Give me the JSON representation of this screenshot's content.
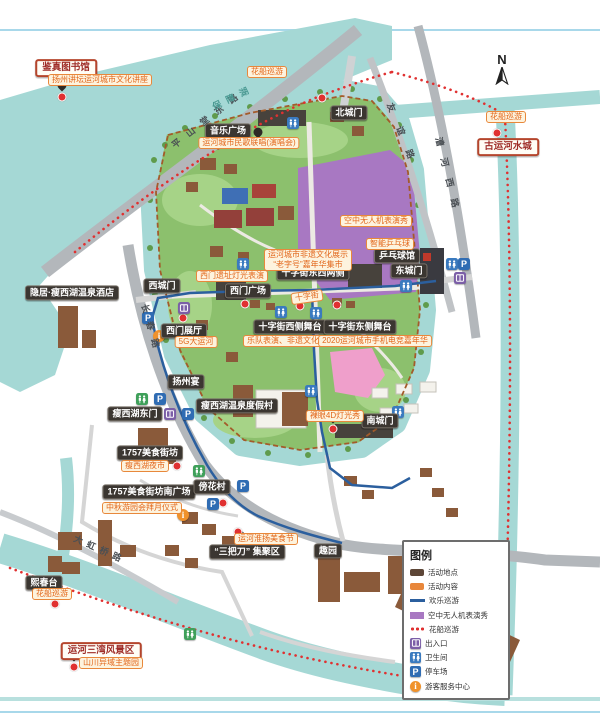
{
  "page": {
    "compass_label": "N"
  },
  "colors": {
    "water": "#a5d8d5",
    "park_green": "#8cc06d",
    "road_gray": "#b3b7bb",
    "route_blue": "#2b5f9e",
    "route_red": "#e03131",
    "boundary_brown": "#a35b2a",
    "drone_purple": "#a878c2",
    "venue_chip": "#3b3631",
    "activity_orange": "#e8873b",
    "landmark_red": "#b5452c"
  },
  "legend": {
    "title": "图例",
    "items": [
      {
        "label": "活动地点",
        "swatch": "venue"
      },
      {
        "label": "活动内容",
        "swatch": "activity"
      },
      {
        "label": "欢乐巡游",
        "swatch": "blueline"
      },
      {
        "label": "空中无人机表演秀",
        "swatch": "purple"
      },
      {
        "label": "花船巡游",
        "swatch": "reddots"
      },
      {
        "label": "出入口",
        "swatch": "entrance"
      },
      {
        "label": "卫生间",
        "swatch": "wc"
      },
      {
        "label": "停车场",
        "swatch": "parking"
      },
      {
        "label": "游客服务中心",
        "swatch": "service"
      }
    ]
  },
  "map": {
    "venues": [
      {
        "text": "北城门",
        "x": 349,
        "y": 113,
        "style": "dark"
      },
      {
        "text": "音乐广场",
        "x": 228,
        "y": 131,
        "style": "dark"
      },
      {
        "text": "西城门",
        "x": 162,
        "y": 286,
        "style": "dark"
      },
      {
        "text": "西门广场",
        "x": 248,
        "y": 291,
        "style": "dark"
      },
      {
        "text": "十字街东西两侧",
        "x": 313,
        "y": 273,
        "style": "dark"
      },
      {
        "text": "乒乓球馆",
        "x": 397,
        "y": 256,
        "style": "dark"
      },
      {
        "text": "东城门",
        "x": 409,
        "y": 271,
        "style": "dark"
      },
      {
        "text": "十字街西侧舞台",
        "x": 290,
        "y": 327,
        "style": "dark"
      },
      {
        "text": "十字街东侧舞台",
        "x": 360,
        "y": 327,
        "style": "dark"
      },
      {
        "text": "西门展厅",
        "x": 184,
        "y": 331,
        "style": "dark"
      },
      {
        "text": "扬州宴",
        "x": 186,
        "y": 382,
        "style": "dark"
      },
      {
        "text": "瘦西湖温泉度假村",
        "x": 237,
        "y": 406,
        "style": "dark"
      },
      {
        "text": "瘦西湖东门",
        "x": 135,
        "y": 414,
        "style": "dark"
      },
      {
        "text": "1757美食街坊",
        "x": 150,
        "y": 453,
        "style": "dark"
      },
      {
        "text": "1757美食街坊南广场",
        "x": 149,
        "y": 492,
        "style": "dark"
      },
      {
        "text": "傍花村",
        "x": 212,
        "y": 487,
        "style": "dark"
      },
      {
        "text": "南城门",
        "x": 380,
        "y": 421,
        "style": "dark"
      },
      {
        "text": "“三把刀” 集聚区",
        "x": 247,
        "y": 552,
        "style": "dark"
      },
      {
        "text": "趣园",
        "x": 328,
        "y": 551,
        "style": "dark"
      },
      {
        "text": "熙春台",
        "x": 44,
        "y": 583,
        "style": "dark"
      },
      {
        "text": "隐居·瘦西湖温泉酒店",
        "x": 72,
        "y": 293,
        "style": "dark"
      },
      {
        "text": "鉴真图书馆",
        "x": 66,
        "y": 68,
        "style": "redbox"
      },
      {
        "text": "古运河水城",
        "x": 508,
        "y": 147,
        "style": "redbox"
      },
      {
        "text": "运河三湾风景区",
        "x": 101,
        "y": 651,
        "style": "redbox"
      }
    ],
    "activities": [
      {
        "text": "花船巡游",
        "x": 267,
        "y": 72
      },
      {
        "text": "花船巡游",
        "x": 506,
        "y": 117
      },
      {
        "text": "扬州讲坛运河城市文化讲座",
        "x": 100,
        "y": 80
      },
      {
        "text": "运河城市民歌联唱(演唱会)",
        "x": 249,
        "y": 143
      },
      {
        "text": "空中无人机表演秀",
        "x": 376,
        "y": 221
      },
      {
        "text": "智能乒乓球",
        "x": 390,
        "y": 244
      },
      {
        "lines": [
          "运河城市非遗文化展示",
          "“老字号”嘉年华集市"
        ],
        "x": 308,
        "y": 260
      },
      {
        "text": "西门遗址灯光表演",
        "x": 232,
        "y": 276
      },
      {
        "text": "十字街",
        "x": 307,
        "y": 297,
        "angle": -8
      },
      {
        "text": "5G大运河",
        "x": 196,
        "y": 342
      },
      {
        "text": "乐队表演、非遗文化演出",
        "x": 291,
        "y": 341
      },
      {
        "text": "2020运河城市手机电竞嘉年华",
        "x": 375,
        "y": 341
      },
      {
        "text": "裸眼4D灯光秀",
        "x": 335,
        "y": 416
      },
      {
        "text": "瘦西湖夜市",
        "x": 145,
        "y": 466
      },
      {
        "text": "中秋游园会拜月仪式",
        "x": 142,
        "y": 508
      },
      {
        "text": "运河淮扬美食节",
        "x": 266,
        "y": 539
      },
      {
        "text": "花船巡游",
        "x": 52,
        "y": 594
      },
      {
        "text": "山川异域主题园",
        "x": 111,
        "y": 663
      }
    ],
    "roads": [
      {
        "text": "平山堂东路",
        "x": 208,
        "y": 118,
        "angle": -38,
        "spacing": 9
      },
      {
        "text": "长春路",
        "x": 152,
        "y": 330,
        "angle": 74,
        "spacing": 9
      },
      {
        "text": "友谊路",
        "x": 404,
        "y": 138,
        "angle": 68,
        "spacing": 16
      },
      {
        "text": "漕河西路",
        "x": 449,
        "y": 178,
        "angle": 76,
        "spacing": 12
      },
      {
        "text": "大虹桥路",
        "x": 100,
        "y": 549,
        "angle": 24,
        "spacing": 5
      }
    ],
    "waters": [
      {
        "text": "保障湖",
        "x": 233,
        "y": 97,
        "angle": -26,
        "spacing": 6
      }
    ],
    "icons": [
      {
        "type": "wc",
        "x": 293,
        "y": 123
      },
      {
        "type": "wc",
        "x": 243,
        "y": 264
      },
      {
        "type": "wc",
        "x": 281,
        "y": 312
      },
      {
        "type": "wc",
        "x": 316,
        "y": 313
      },
      {
        "type": "wc",
        "x": 406,
        "y": 286
      },
      {
        "type": "wc",
        "x": 311,
        "y": 391
      },
      {
        "type": "wc",
        "x": 398,
        "y": 412
      },
      {
        "type": "wc",
        "x": 452,
        "y": 264
      },
      {
        "type": "wc2",
        "x": 142,
        "y": 399
      },
      {
        "type": "wc2",
        "x": 199,
        "y": 471
      },
      {
        "type": "wc2",
        "x": 190,
        "y": 634
      },
      {
        "type": "parking",
        "x": 160,
        "y": 399
      },
      {
        "type": "parking",
        "x": 188,
        "y": 414
      },
      {
        "type": "parking",
        "x": 148,
        "y": 318
      },
      {
        "type": "parking",
        "x": 464,
        "y": 264
      },
      {
        "type": "parking",
        "x": 243,
        "y": 486
      },
      {
        "type": "parking",
        "x": 213,
        "y": 504
      },
      {
        "type": "entrance",
        "x": 184,
        "y": 308
      },
      {
        "type": "entrance",
        "x": 460,
        "y": 278
      },
      {
        "type": "entrance",
        "x": 170,
        "y": 414
      },
      {
        "type": "service",
        "x": 159,
        "y": 336
      },
      {
        "type": "service",
        "x": 183,
        "y": 515
      }
    ],
    "pins": [
      {
        "x": 62,
        "y": 93
      },
      {
        "x": 258,
        "y": 140
      },
      {
        "x": 245,
        "y": 300
      },
      {
        "x": 333,
        "y": 425
      },
      {
        "x": 240,
        "y": 543
      },
      {
        "x": 55,
        "y": 600
      },
      {
        "x": 74,
        "y": 663
      },
      {
        "x": 177,
        "y": 462
      }
    ],
    "dots": [
      {
        "x": 322,
        "y": 98
      },
      {
        "x": 497,
        "y": 133
      },
      {
        "x": 300,
        "y": 306
      },
      {
        "x": 337,
        "y": 305
      },
      {
        "x": 183,
        "y": 318
      },
      {
        "x": 238,
        "y": 532
      },
      {
        "x": 197,
        "y": 484
      },
      {
        "x": 223,
        "y": 503
      }
    ]
  }
}
